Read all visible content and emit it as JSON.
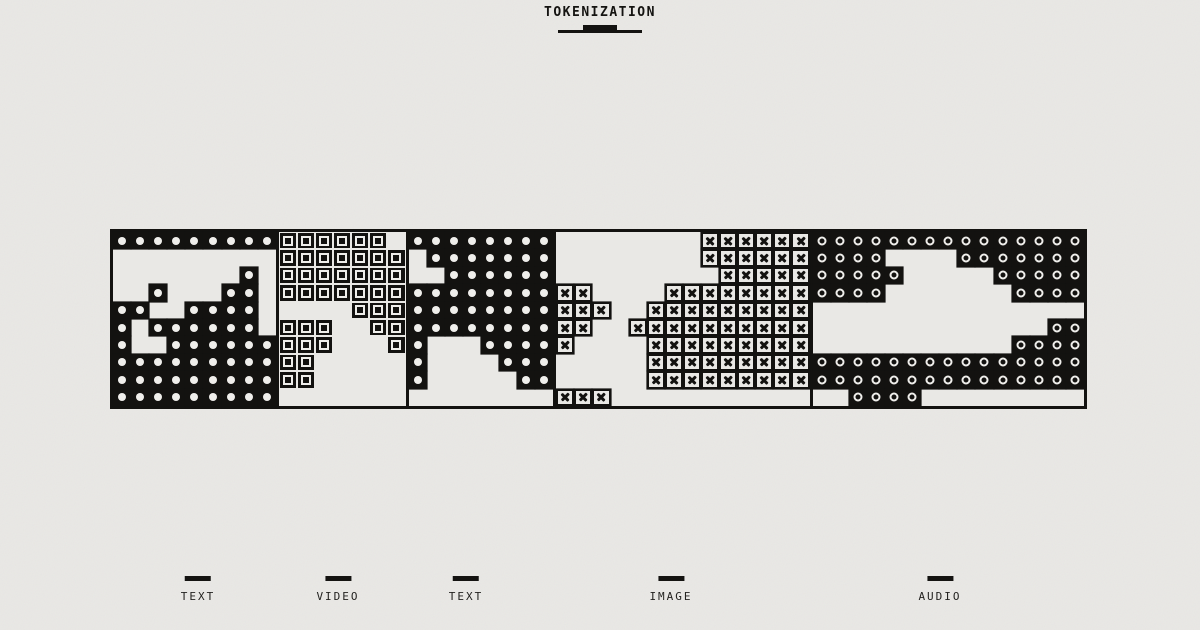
{
  "header": {
    "title": "TOKENIZATION"
  },
  "colors": {
    "background": "#e9e8e5",
    "ink": "#131210",
    "glyph_light": "#efeeeb"
  },
  "band": {
    "rows": 10,
    "sections": [
      {
        "id": "text-1",
        "modality": "TEXT",
        "glyph": "dot",
        "cols": 9,
        "pattern": [
          "111111111",
          "000000000",
          "000000010",
          "001000110",
          "110011110",
          "101111110",
          "100111111",
          "111111111",
          "111111111",
          "111111111"
        ]
      },
      {
        "id": "video",
        "modality": "VIDEO",
        "glyph": "square",
        "cols": 7,
        "pattern": [
          "1111110",
          "1111111",
          "1111111",
          "1111111",
          "0000111",
          "1110011",
          "1110001",
          "1100000",
          "1100000",
          "0000000"
        ]
      },
      {
        "id": "text-2",
        "modality": "TEXT",
        "glyph": "dot",
        "cols": 8,
        "pattern": [
          "11111111",
          "01111111",
          "00111111",
          "11111111",
          "11111111",
          "11111111",
          "10001111",
          "10000111",
          "10000011",
          "00000000"
        ]
      },
      {
        "id": "image",
        "modality": "IMAGE",
        "glyph": "xbox",
        "cols": 14,
        "pattern": [
          "00000000111111",
          "00000000111111",
          "00000000011111",
          "11000011111111",
          "11100111111111",
          "11001111111111",
          "10000111111111",
          "00000111111111",
          "00000111111111",
          "11100000000000"
        ]
      },
      {
        "id": "audio",
        "modality": "AUDIO",
        "glyph": "ring",
        "cols": 15,
        "pattern": [
          "111111111111111",
          "111100001111111",
          "111110000011111",
          "111100000001111",
          "000000000000000",
          "000000000000011",
          "000000000001111",
          "111111111111111",
          "111111111111111",
          "001111000000000"
        ]
      }
    ]
  },
  "legend": {
    "items": [
      {
        "label": "TEXT",
        "x": 198
      },
      {
        "label": "VIDEO",
        "x": 338
      },
      {
        "label": "TEXT",
        "x": 466
      },
      {
        "label": "IMAGE",
        "x": 671
      },
      {
        "label": "AUDIO",
        "x": 940
      }
    ]
  }
}
